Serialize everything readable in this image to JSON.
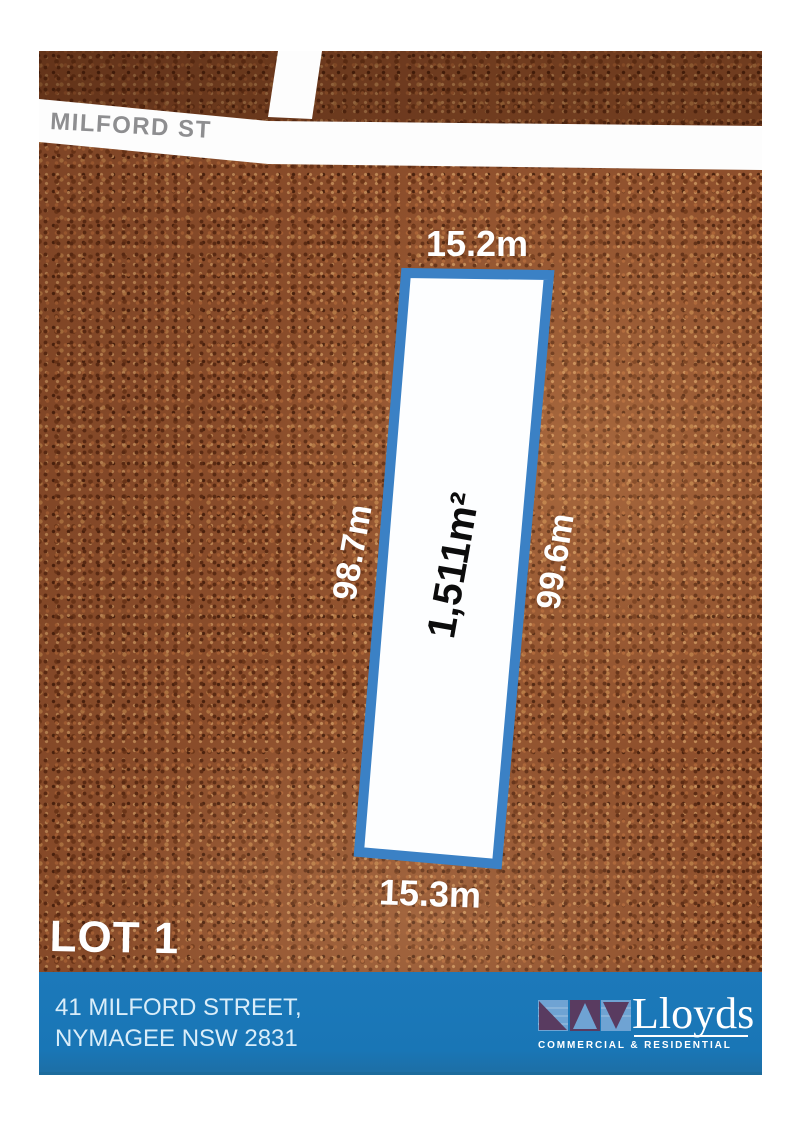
{
  "map": {
    "street_label": "MILFORD ST",
    "lot_label": "LOT 1",
    "parcel": {
      "area_label": "1,511m²",
      "top_dim": "15.2m",
      "bottom_dim": "15.3m",
      "left_dim": "98.7m",
      "right_dim": "99.6m"
    }
  },
  "footer": {
    "address_line1": "41 MILFORD STREET,",
    "address_line2": "NYMAGEE NSW 2831",
    "brand_name": "Lloyds",
    "brand_tagline": "COMMERCIAL & RESIDENTIAL"
  },
  "colors": {
    "parcel_border": "#3b81c5",
    "parcel_fill": "#fdfeff",
    "road": "#fdfdfd",
    "street_label_gray": "#8e8e90",
    "terrain_base": "#8e4f2c",
    "footer_background": "#1a78b9",
    "address_text": "#d9edf9",
    "logo_light_blue": "#6fa3d3",
    "logo_purple": "#593b60"
  }
}
